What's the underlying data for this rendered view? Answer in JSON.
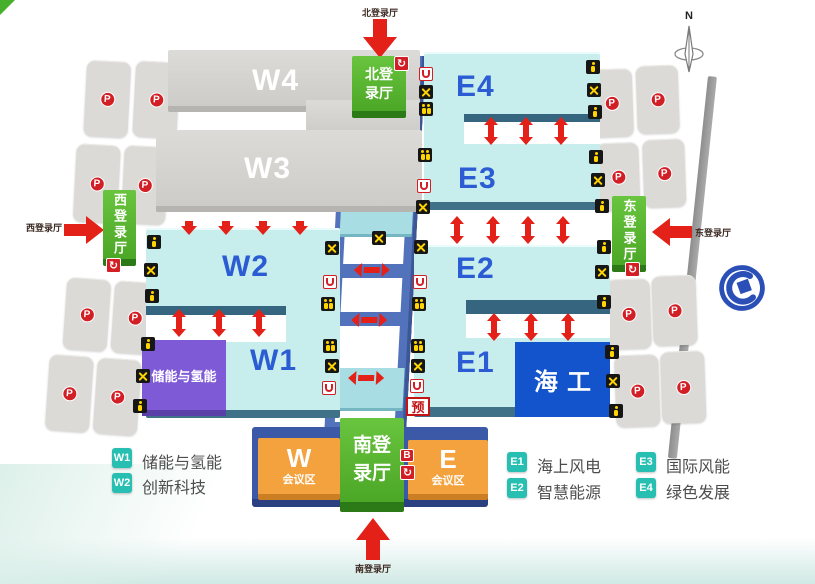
{
  "glyphs": {
    "parking": "P",
    "circular_arrow": "↻",
    "bus": "B",
    "reservation": "预"
  },
  "compass": {
    "north": "N"
  },
  "halls": {
    "w4": "W4",
    "w3": "W3",
    "w2": "W2",
    "w1": "W1",
    "e4": "E4",
    "e3": "E3",
    "e2": "E2",
    "e1": "E1",
    "w1_zone": "储能与氢能",
    "e1_zone": "海工"
  },
  "entrances": {
    "north": {
      "block_line1": "北登",
      "block_line2": "录厅",
      "arrow_label": "北登录厅"
    },
    "south": {
      "block_line1": "南登",
      "block_line2": "录厅",
      "arrow_label": "南登录厅"
    },
    "west": {
      "block": "西登录厅",
      "arrow_label": "西登录厅"
    },
    "east": {
      "block": "东登录厅",
      "arrow_label": "东登录厅"
    }
  },
  "conference": {
    "west_letter": "W",
    "west_label": "会议区",
    "east_letter": "E",
    "east_label": "会议区"
  },
  "legend": {
    "items": [
      {
        "badge": "W1",
        "label": "储能与氢能"
      },
      {
        "badge": "W2",
        "label": "创新科技"
      },
      {
        "badge": "E1",
        "label": "海上风电"
      },
      {
        "badge": "E2",
        "label": "智慧能源"
      },
      {
        "badge": "E3",
        "label": "国际风能"
      },
      {
        "badge": "E4",
        "label": "绿色发展"
      }
    ]
  },
  "colors": {
    "hall_cyan": "#c7eeec",
    "hall_gray": "#d2d1cd",
    "entrance_green": "#4ba726",
    "conference_orange": "#f3a23e",
    "corridor_blue": "#5372bc",
    "zone_purple": "#7e5ad6",
    "zone_blue": "#1353cb",
    "arrow_red": "#e32119",
    "legend_teal": "#27bfb1"
  }
}
